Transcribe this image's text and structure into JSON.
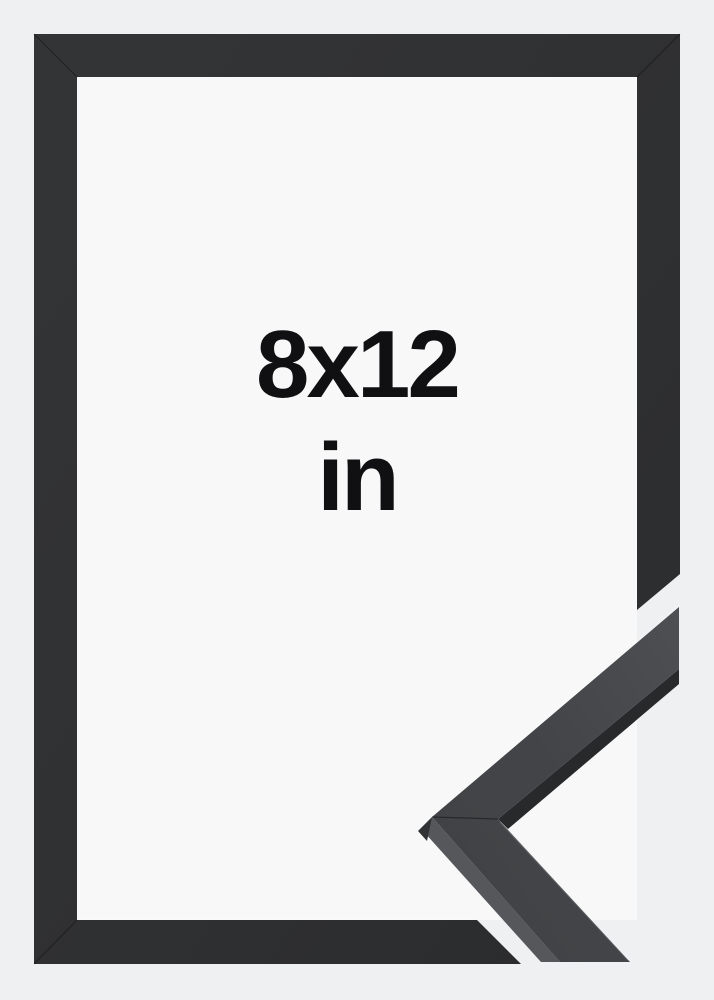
{
  "size_label": {
    "dimensions": "8x12",
    "unit": "in"
  },
  "colors": {
    "background": "#eff0f1",
    "frame_opening": "#f8f8f9",
    "frame": "#2c2d2f",
    "sample_face": "#3e4043",
    "sample_side_light": "#55575a",
    "sample_side_dark": "#28292b",
    "sample_tip_facet": "#303234",
    "label_text": "#101012"
  }
}
